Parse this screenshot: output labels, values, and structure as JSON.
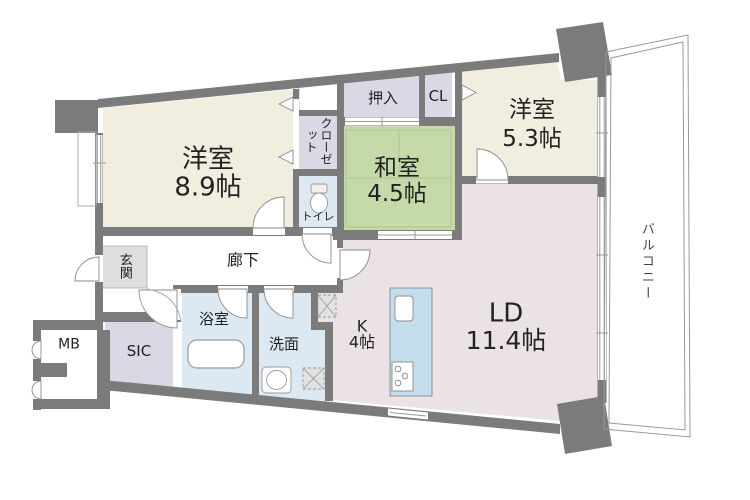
{
  "plan": {
    "title": "マンション間取り図",
    "colors": {
      "wall": "#7b7b7b",
      "western_room": "#f1eee0",
      "tatami_room": "#c6d9a9",
      "living_dining": "#ebe2e8",
      "wet_area": "#dde9f2",
      "storage": "#d9d8e4",
      "counter": "#c3dded",
      "genkan_tile": "#dedede",
      "tatami_line": "#abc68f",
      "outline": "#999999"
    },
    "rooms": {
      "main_bedroom": {
        "name": "洋室",
        "size": "8.9帖"
      },
      "tatami_room": {
        "name": "和室",
        "size": "4.5帖"
      },
      "second_bedroom": {
        "name": "洋室",
        "size": "5.3帖"
      },
      "living_dining": {
        "name": "LD",
        "size": "11.4帖"
      },
      "kitchen": {
        "name": "K",
        "size": "4帖"
      }
    },
    "labels": {
      "oshiire": "押入",
      "cl": "CL",
      "closet": "クローゼット",
      "toilet": "トイレ",
      "genkan": "玄関",
      "corridor": "廊下",
      "bathroom": "浴室",
      "washroom": "洗面",
      "sic": "SIC",
      "meter_box": "MB",
      "balcony": "バルコニー"
    }
  }
}
